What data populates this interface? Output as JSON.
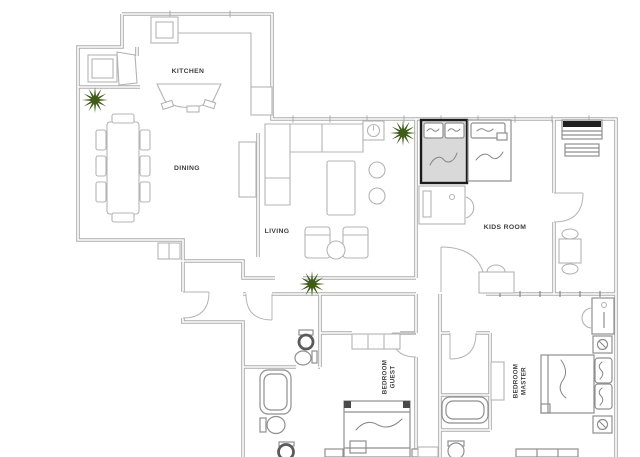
{
  "app": {
    "type": "architectural-floor-plan"
  },
  "rooms": {
    "kitchen": {
      "label": "KITCHEN"
    },
    "dining": {
      "label": "DINING"
    },
    "living": {
      "label": "LIVING"
    },
    "kids": {
      "label": "KIDS ROOM"
    },
    "guest": {
      "line1": "GUEST",
      "line2": "BEDROOM"
    },
    "master": {
      "line1": "MASTER",
      "line2": "BEDROOM"
    }
  },
  "icons": {
    "plant": "starburst-plant",
    "door": "quarter-arc-door-swing",
    "toilet": "toilet-top-view",
    "bathtub": "bathtub-top-view",
    "sink": "oval-sink",
    "lamp": "nightstand-lamp"
  },
  "colors": {
    "background": "#ffffff",
    "wall": "#acacac",
    "furniture": "#b4b4b4",
    "text": "#3f3f3f",
    "plant": "#3f5c1a",
    "highlight_border": "#1c1c1c",
    "highlight_fill": "#d9d9d9",
    "fixture_dark": "#5a5a5a",
    "shelf_band": "#1f1f1f"
  }
}
